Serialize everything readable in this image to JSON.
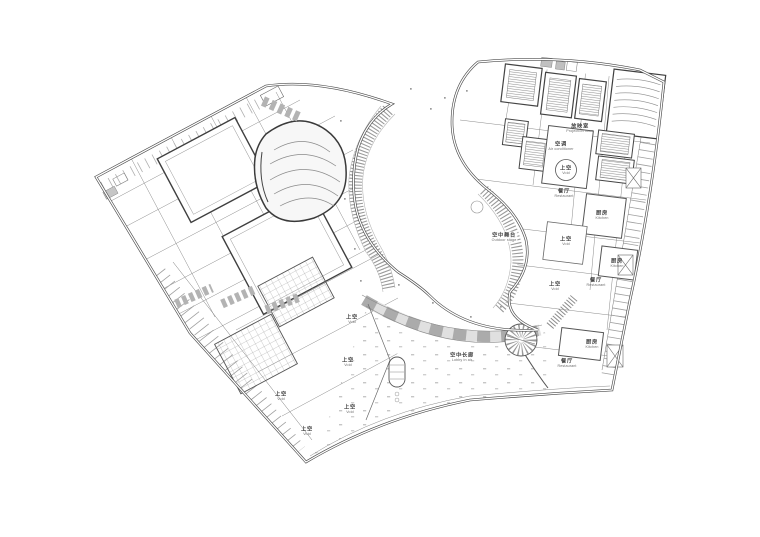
{
  "page": {
    "type": "architectural-floor-plan",
    "description": "Fan-shaped cultural centre upper-level floor plan: west wing with halls and skylight voids, east wing with projection rooms and restaurants, joined by an aerial corridor around a curved court",
    "background": "#ffffff"
  },
  "colors": {
    "outer_wall": "#4a4a4a",
    "partition": "#8a8a8a",
    "hatch": "#8f8f8f",
    "gray_band": "#b3b3b3",
    "label_zh": "#474747",
    "label_en": "#6d6d6d"
  },
  "legend_icons": {
    "stair_hatch": "closely spaced tread lines",
    "skylight": "cross grid hatch",
    "void": "white open area"
  },
  "labels": [
    {
      "id": "projection-room",
      "zh": "放映室",
      "en": "Projection room"
    },
    {
      "id": "air-conditioner",
      "zh": "空调",
      "en": "Air conditioner"
    },
    {
      "id": "void-circle",
      "zh": "上空",
      "en": "Void"
    },
    {
      "id": "restaurant-1",
      "zh": "餐厅",
      "en": "Restaurant"
    },
    {
      "id": "kitchen-1",
      "zh": "厨房",
      "en": "Kitchen"
    },
    {
      "id": "void-2",
      "zh": "上空",
      "en": "Void"
    },
    {
      "id": "kitchen-2",
      "zh": "厨房",
      "en": "Kitchen"
    },
    {
      "id": "restaurant-2",
      "zh": "餐厅",
      "en": "Restaurant"
    },
    {
      "id": "void-3",
      "zh": "上空",
      "en": "Void"
    },
    {
      "id": "kitchen-3",
      "zh": "厨房",
      "en": "Kitchen"
    },
    {
      "id": "restaurant-3",
      "zh": "餐厅",
      "en": "Restaurant"
    },
    {
      "id": "outdoor-stage",
      "zh": "空中舞台",
      "en": "Outdoor stage"
    },
    {
      "id": "lobby-in-air",
      "zh": "空中长廊",
      "en": "Lobby in air"
    },
    {
      "id": "void-west-1",
      "zh": "上空",
      "en": "Void"
    },
    {
      "id": "void-west-2",
      "zh": "上空",
      "en": "Void"
    },
    {
      "id": "void-west-3",
      "zh": "上空",
      "en": "Void"
    },
    {
      "id": "void-west-4",
      "zh": "上空",
      "en": "Void"
    },
    {
      "id": "void-west-5",
      "zh": "上空",
      "en": "Void"
    }
  ]
}
